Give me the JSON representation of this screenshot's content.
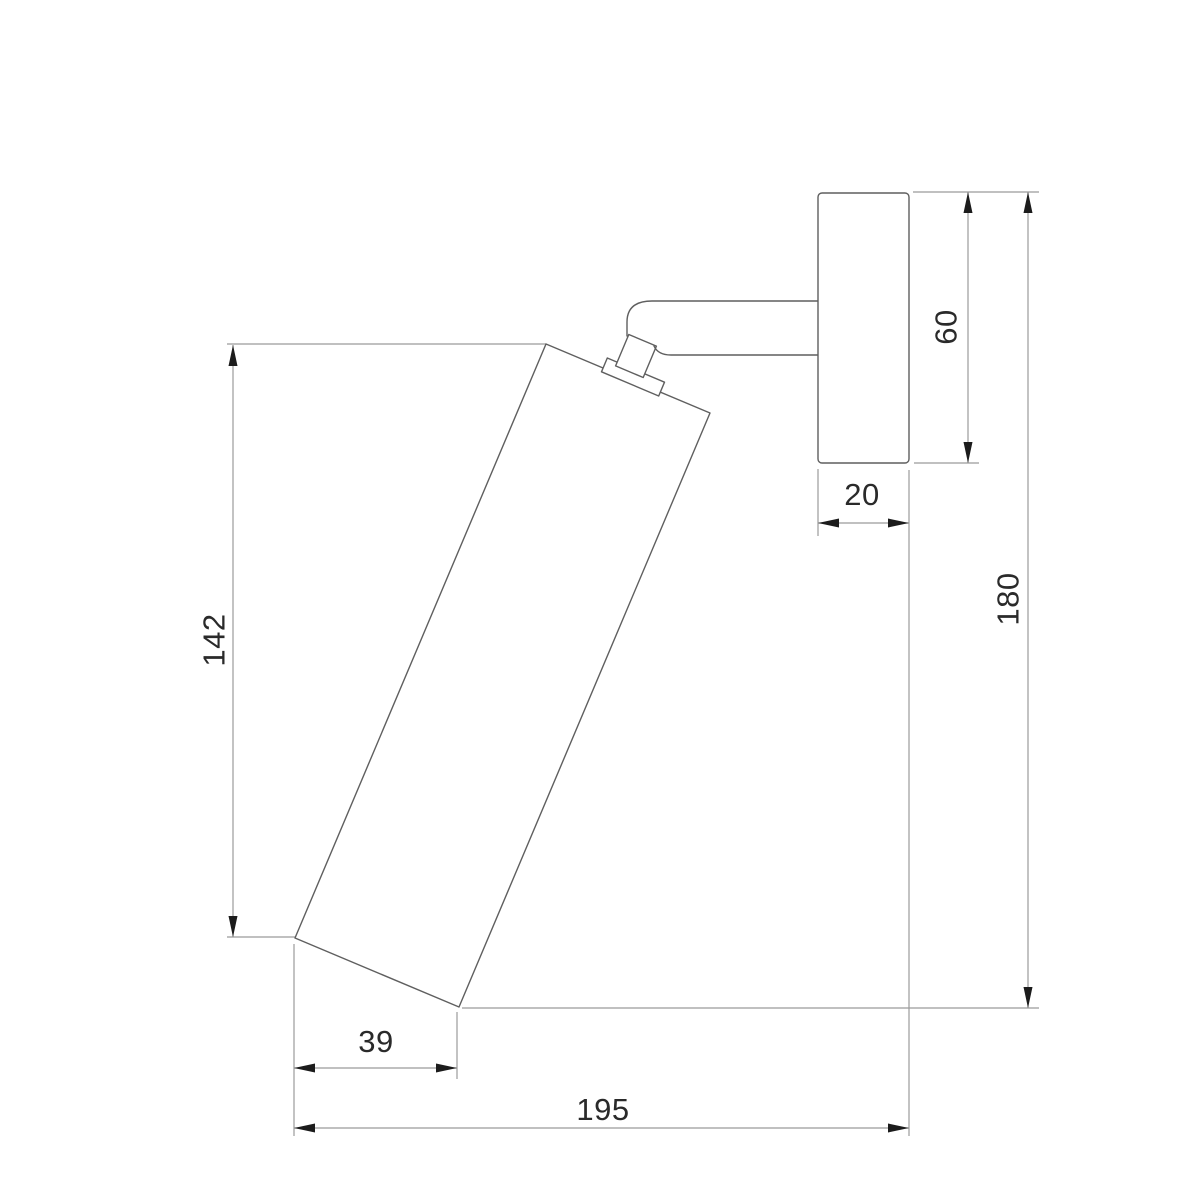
{
  "drawing": {
    "kind": "technical-dimension-drawing",
    "subject": "wall-mounted adjustable spotlight, side elevation",
    "dimensions": {
      "d142": "142",
      "d60": "60",
      "d20": "20",
      "d180": "180",
      "d39": "39",
      "d195": "195"
    },
    "colors": {
      "background": "#ffffff",
      "object_line": "#5f5f5f",
      "dimension_line": "#9b9b9b",
      "arrowhead": "#1c1c1c",
      "text": "#2a2a2a"
    }
  }
}
